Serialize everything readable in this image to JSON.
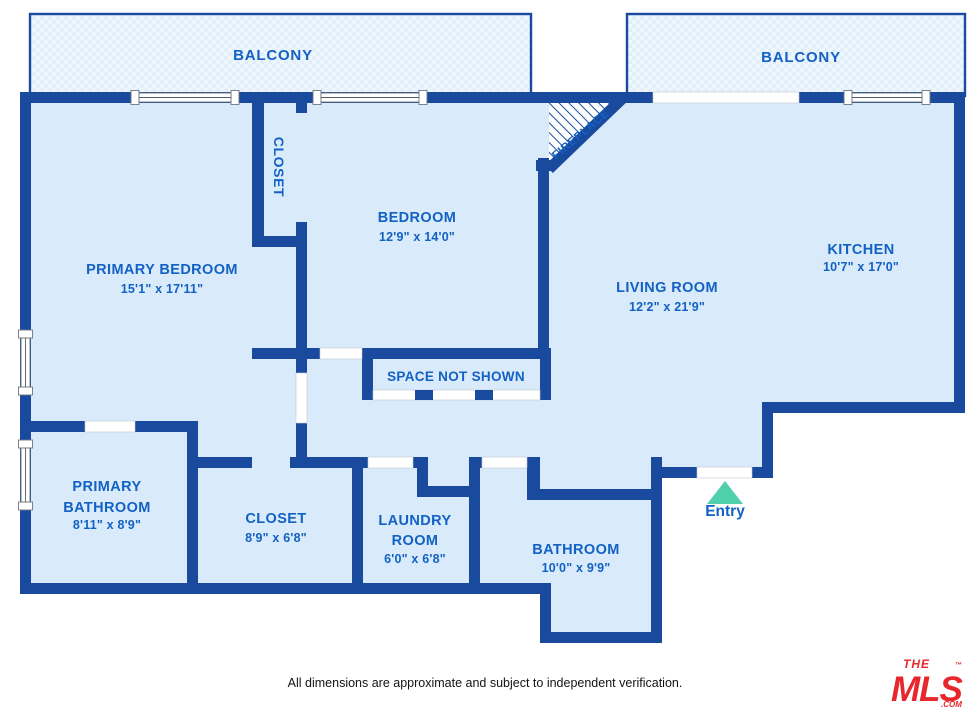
{
  "floor_plan": {
    "balconies": [
      {
        "label": "BALCONY"
      },
      {
        "label": "BALCONY"
      }
    ],
    "rooms": [
      {
        "lines": [
          "PRIMARY BEDROOM"
        ],
        "dims": "15'1\" x 17'11\""
      },
      {
        "lines": [
          "BEDROOM"
        ],
        "dims": "12'9\" x 14'0\""
      },
      {
        "lines": [
          "LIVING ROOM"
        ],
        "dims": "12'2\" x 21'9\""
      },
      {
        "lines": [
          "KITCHEN"
        ],
        "dims": "10'7\" x 17'0\""
      },
      {
        "lines": [
          "PRIMARY",
          "BATHROOM"
        ],
        "dims": "8'11\" x 8'9\""
      },
      {
        "lines": [
          "CLOSET"
        ],
        "dims": "8'9\" x 6'8\""
      },
      {
        "lines": [
          "LAUNDRY",
          "ROOM"
        ],
        "dims": "6'0\" x 6'8\""
      },
      {
        "lines": [
          "BATHROOM"
        ],
        "dims": "10'0\" x 9'9\""
      }
    ],
    "labels": {
      "closet_upper": "CLOSET",
      "fireplace": "FIREPLACE",
      "space_not_shown": "SPACE NOT SHOWN",
      "entry": "Entry"
    }
  },
  "footer": {
    "disclaimer": "All dimensions are approximate and subject to independent verification."
  },
  "logo": {
    "the": "THE",
    "mls": "MLS",
    "tm": "™",
    "com": ".COM"
  },
  "colors": {
    "wall_blue": "#1a4a9d",
    "floor_blue": "#d9eafa",
    "balcony_fill": "#edf5fd",
    "label_blue": "#1261c4",
    "entry_triangle_teal": "#4fcfab",
    "logo_red": "#e8262d"
  }
}
